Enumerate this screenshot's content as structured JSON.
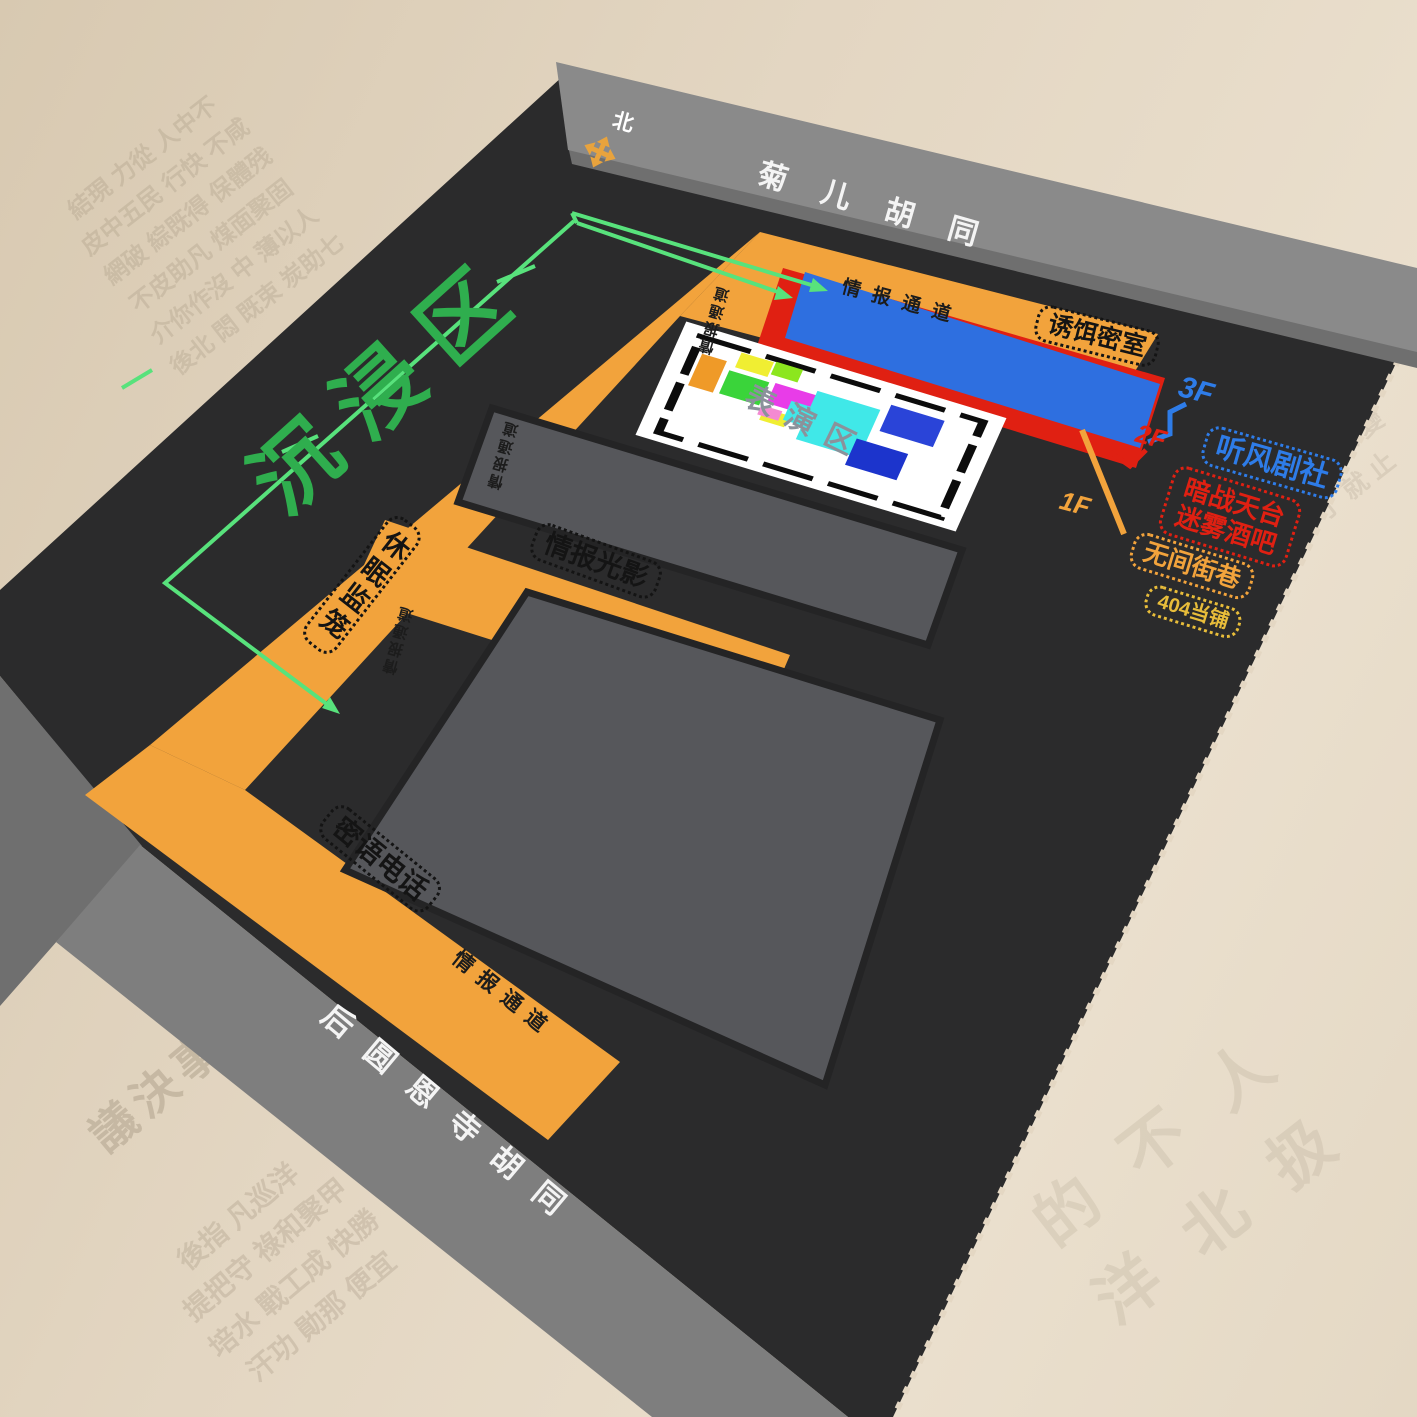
{
  "streets": {
    "top": "菊儿胡同",
    "bottom": "后圆恩寺胡同"
  },
  "compass": {
    "north_label": "北"
  },
  "zone": {
    "title": "沉浸区"
  },
  "passages": {
    "label": "情报通道"
  },
  "rooms": {
    "bait_room": "诱饵密室",
    "intel_lights": "情报光影",
    "dormant_cage": "休眠监笼",
    "whisper_phone": "密语电话",
    "stage_area": "表演区"
  },
  "floors": [
    {
      "level": "3F",
      "name": "听风剧社"
    },
    {
      "level": "2F",
      "name": "暗战天台",
      "name2": "迷雾酒吧"
    },
    {
      "level": "1F",
      "name": "无间街巷",
      "name2": "404当铺"
    }
  ],
  "colors": {
    "paper": "#e3d6c2",
    "map_dark": "#2b2b2c",
    "street_gray": "#8a8a8a",
    "corridor_orange": "#f2a33c",
    "building_gray": "#56575b",
    "floor3_blue": "#2e6fe0",
    "floor2_red": "#e02012",
    "floor1_orange": "#f2a33c",
    "pawnshop_gold": "#e8bd3a",
    "zone_green": "#2fae4e",
    "arrow_green": "#58e27c"
  },
  "background": {
    "texture_texts": [
      "結現 力從 人中不\n皮中五民 行快 不咸\n網破 綜既得 保體残\n不皮助凡 煤面聚固\n介你作沒 中 薄以人\n後北 悶 既束 炭助七",
      "議決事軍會",
      "後指 凡巡洋\n提把守 祿和聚甲\n培水 戰工成 快勝\n汗功 勛那 便宜",
      "的 不 人\n洋 北 扱",
      "閥 軍 那 歐 變\n使 了 就 止"
    ]
  }
}
